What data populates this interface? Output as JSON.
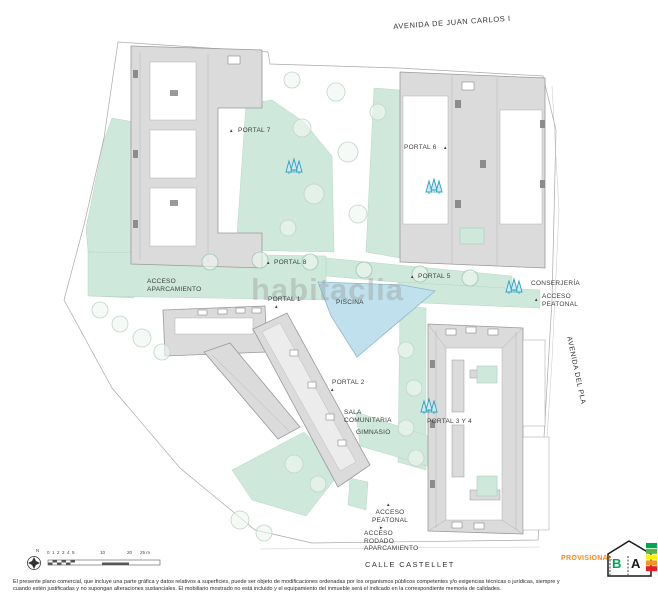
{
  "watermark": "habitaclia",
  "streets": {
    "top": "AVENIDA DE JUAN CARLOS I",
    "right": "AVENIDA DEL PLA",
    "bottom": "CALLE CASTELLET"
  },
  "labels": {
    "portal7": "PORTAL 7",
    "portal6": "PORTAL 6",
    "portal8": "PORTAL 8",
    "portal5": "PORTAL 5",
    "portal1": "PORTAL 1",
    "portal2": "PORTAL 2",
    "portal34": "PORTAL 3 Y 4",
    "piscina": "PISCINA",
    "sala_comunitaria": "SALA\nCOMUNITARIA",
    "gimnasio": "GIMNASIO",
    "conserjeria": "CONSERJERÍA",
    "acceso_aparcamiento": "ACCESO\nAPARCAMIENTO",
    "acceso_peatonal_este": "ACCESO\nPEATONAL",
    "acceso_peatonal_sur": "ACCESO\nPEATONAL",
    "acceso_rodado": "ACCESO\nRODADO\nAPARCAMIENTO"
  },
  "icons": {
    "triangle_up": "▲",
    "triangle_right": "►",
    "compass_north": "N"
  },
  "scale_bar": {
    "ticks": [
      "0",
      "1",
      "2",
      "3",
      "4",
      "5",
      "10",
      "20",
      "25 m"
    ]
  },
  "footer": {
    "provisional": "PROVISIONAL",
    "disclaimer_line1": "El presente plano comercial, que incluye una parte gráfica y datos relativos a superficies, puede ser objeto de modificaciones ordenadas por los organismos públicos competentes y/o exigencias técnicas o jurídicas, siempre y",
    "disclaimer_line2": "cuando estén justificadas y no supongan alteraciones sustanciales. El mobiliario mostrado no está incluido y el equipamiento del inmueble será el indicado en la correspondiente memoria de calidades."
  },
  "energy_label": {
    "letters": [
      "B",
      "A"
    ]
  },
  "colors": {
    "building_fill": "#dbdbdb",
    "building_stroke": "#9a9a9a",
    "green_area": "#cfe8dc",
    "pool_fill": "#bfe0ec",
    "tree_accent": "#2d9fc0",
    "provisional_orange": "#F28C1E"
  }
}
